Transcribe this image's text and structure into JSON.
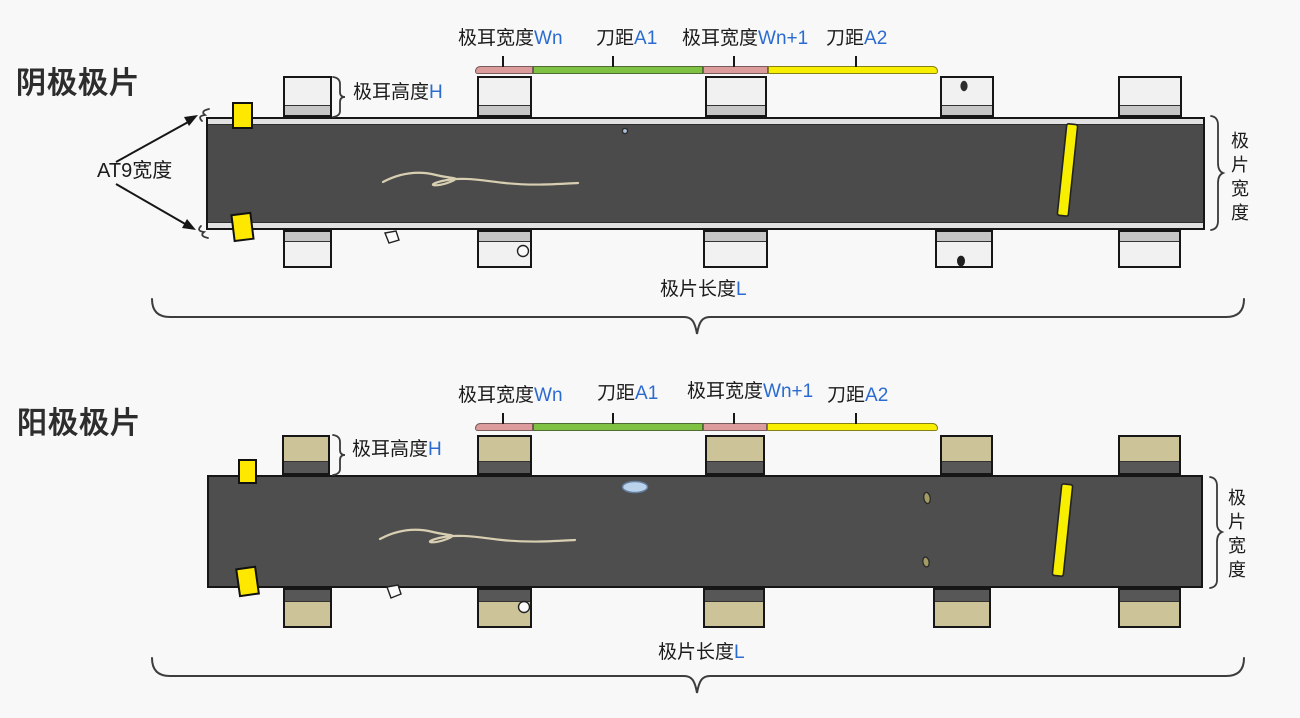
{
  "cathode": {
    "title": "阴极极片",
    "at9_width_label": "AT9宽度",
    "tab_height_label": "极耳高度",
    "tab_height_var": "H",
    "tab_width_label": "极耳宽度",
    "tab_width_var": "Wn",
    "knife_pitch1_label": "刀距",
    "knife_pitch1_var": "A1",
    "tab_width_next_label": "极耳宽度",
    "tab_width_next_var": "Wn+1",
    "knife_pitch2_label": "刀距",
    "knife_pitch2_var": "A2",
    "sheet_width_label": "极片宽度",
    "sheet_length_label": "极片长度",
    "sheet_length_var": "L"
  },
  "anode": {
    "title": "阳极极片",
    "tab_height_label": "极耳高度",
    "tab_height_var": "H",
    "tab_width_label": "极耳宽度",
    "tab_width_var": "Wn",
    "knife_pitch1_label": "刀距",
    "knife_pitch1_var": "A1",
    "tab_width_next_label": "极耳宽度",
    "tab_width_next_var": "Wn+1",
    "knife_pitch2_label": "刀距",
    "knife_pitch2_var": "A2",
    "sheet_width_label": "极片宽度",
    "sheet_length_label": "极片长度",
    "sheet_length_var": "L"
  },
  "colors": {
    "accent_blue": "#2b6bd0",
    "bar_pink": "#dc9c9c",
    "bar_green": "#7fc142",
    "bar_yellow": "#f8ee00",
    "marker_yellow": "#ffe800",
    "cathode_sheet": "#4b4b4b",
    "anode_sheet": "#4e4e4e",
    "cathode_tab_fill": "#f1f1f1",
    "cathode_tab_band": "#c6c6c6",
    "anode_tab_fill": "#cdc398",
    "anode_tab_band": "#575757",
    "background": "#f8f8f8"
  }
}
